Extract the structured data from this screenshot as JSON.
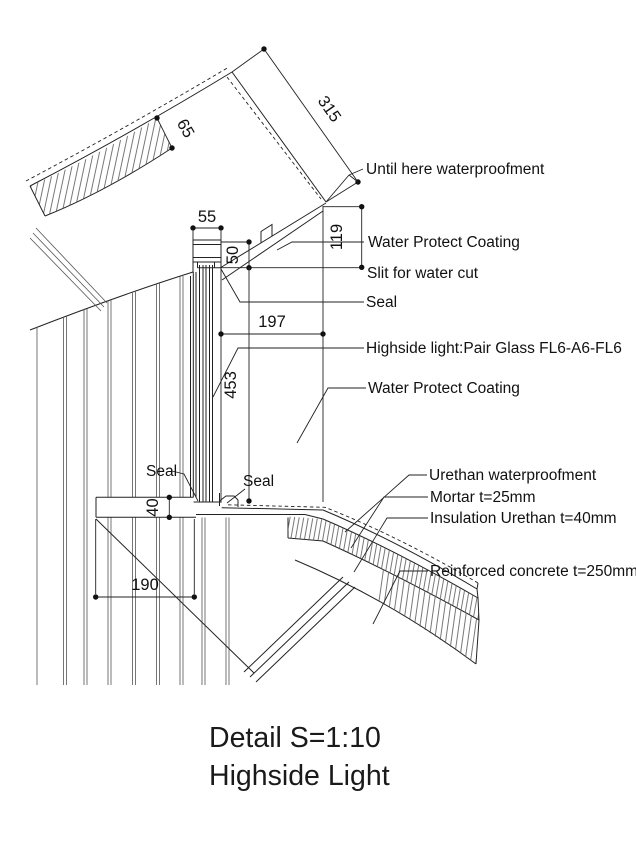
{
  "drawing": {
    "title": {
      "line1": "Detail S=1:10",
      "line2": "Highside Light"
    },
    "dimensions": {
      "roof_edge_length": "315",
      "roof_slab_thickness": "65",
      "head_width": "55",
      "head_height": "50",
      "edge_drop": "119",
      "head_to_edge_offset": "197",
      "glass_height": "453",
      "sill_ledge_thickness": "40",
      "ledge_width": "190"
    },
    "labels": {
      "until_here": "Until here waterproofment",
      "water_protect_coating_top": "Water Protect Coating",
      "slit_for_water_cut": "Slit for water cut",
      "seal_head": "Seal",
      "highside_light_glass": "Highside light:Pair Glass FL6-A6-FL6",
      "water_protect_coating_mid": "Water Protect Coating",
      "seal_left": "Seal",
      "seal_right": "Seal",
      "urethan_waterproofment": "Urethan waterproofment",
      "mortar": "Mortar t=25mm",
      "insulation_urethan": "Insulation Urethan t=40mm",
      "reinforced_concrete": "Reinforced concrete t=250mm"
    },
    "colors": {
      "line": "#222222",
      "text": "#111111",
      "background": "#ffffff"
    }
  }
}
